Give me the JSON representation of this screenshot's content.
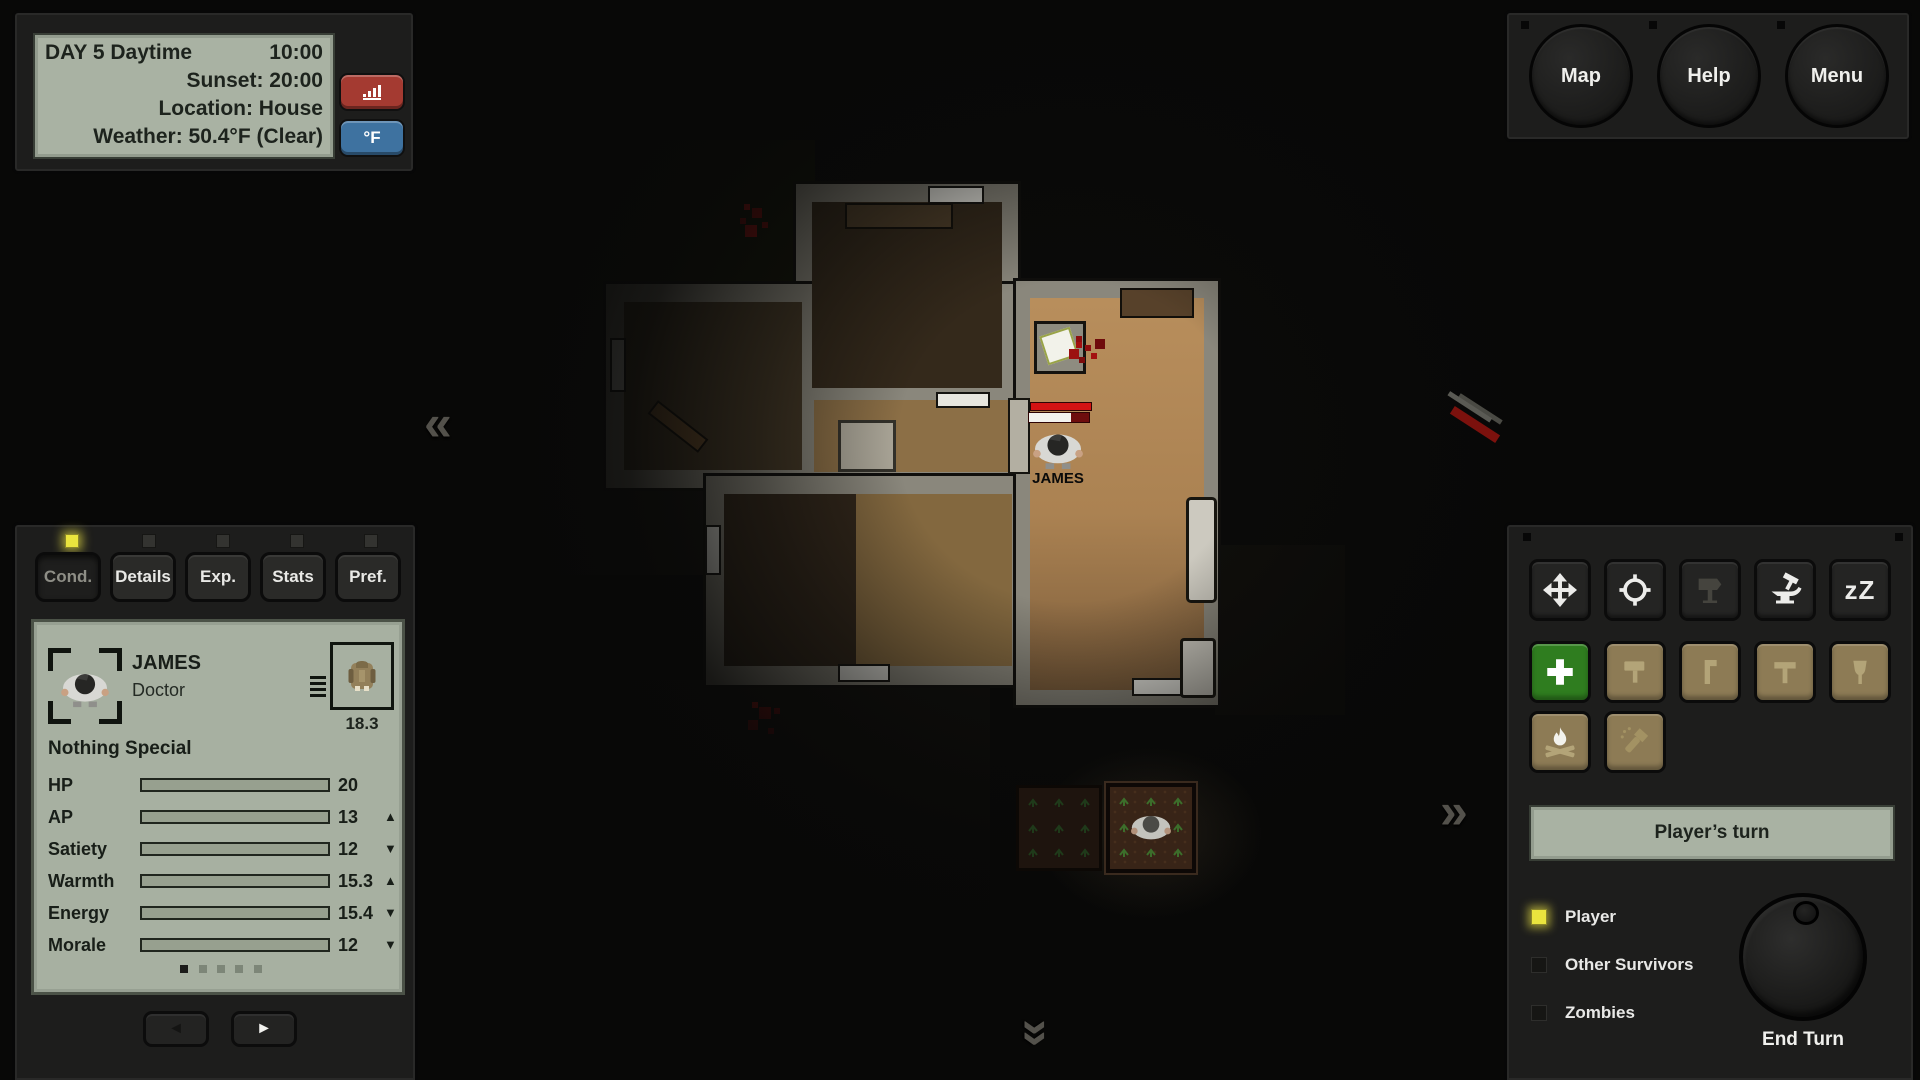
{
  "info_panel": {
    "day_label": "DAY 5 Daytime",
    "time": "10:00",
    "sunset": "Sunset: 20:00",
    "location": "Location: House",
    "weather": "Weather: 50.4°F (Clear)",
    "temp_unit_label": "°F"
  },
  "top_menu": {
    "map": "Map",
    "help": "Help",
    "menu": "Menu"
  },
  "character_panel": {
    "tabs": [
      {
        "label": "Cond.",
        "active": true
      },
      {
        "label": "Details",
        "active": false
      },
      {
        "label": "Exp.",
        "active": false
      },
      {
        "label": "Stats",
        "active": false
      },
      {
        "label": "Pref.",
        "active": false
      }
    ],
    "name": "JAMES",
    "role": "Doctor",
    "carry_weight": "18.3",
    "trait": "Nothing Special",
    "stats": [
      {
        "label": "HP",
        "value": "20",
        "pct": 100,
        "trend": ""
      },
      {
        "label": "AP",
        "value": "13",
        "pct": 64,
        "trend": "▲"
      },
      {
        "label": "Satiety",
        "value": "12",
        "pct": 59,
        "trend": "▼"
      },
      {
        "label": "Warmth",
        "value": "15.3",
        "pct": 74,
        "trend": "▲"
      },
      {
        "label": "Energy",
        "value": "15.4",
        "pct": 76,
        "trend": "▼"
      },
      {
        "label": "Morale",
        "value": "12",
        "pct": 59,
        "trend": "▼"
      }
    ],
    "page_count": 5,
    "active_page": 1,
    "prev_glyph": "◄",
    "next_glyph": "►"
  },
  "action_panel": {
    "tools": [
      "move",
      "target",
      "signpost",
      "craft",
      "sleep",
      "heal",
      "sledgehammer",
      "crowbar",
      "hammer",
      "shovel",
      "campfire",
      "flashlight"
    ],
    "sleep_glyph": "zZ",
    "turn_status": "Player’s turn",
    "legend": [
      {
        "label": "Player",
        "color": "#eae43e"
      },
      {
        "label": "Other Survivors",
        "color": "#161614"
      },
      {
        "label": "Zombies",
        "color": "#161614"
      }
    ],
    "end_turn_label": "End Turn"
  },
  "map": {
    "player_label": "JAMES",
    "player_health_pct": 70,
    "nav_left": "«",
    "nav_right": "»",
    "nav_down": "»"
  },
  "colors": {
    "accent_yellow": "#eae43e",
    "lcd_screen": "#a9b2a3",
    "red_button": "#a43a31",
    "blue_button": "#3e72a0",
    "green_button": "#2f7d1f",
    "tan_button": "#8d7b55",
    "blood": "#a31010",
    "wood_light": "#b88e5c"
  }
}
